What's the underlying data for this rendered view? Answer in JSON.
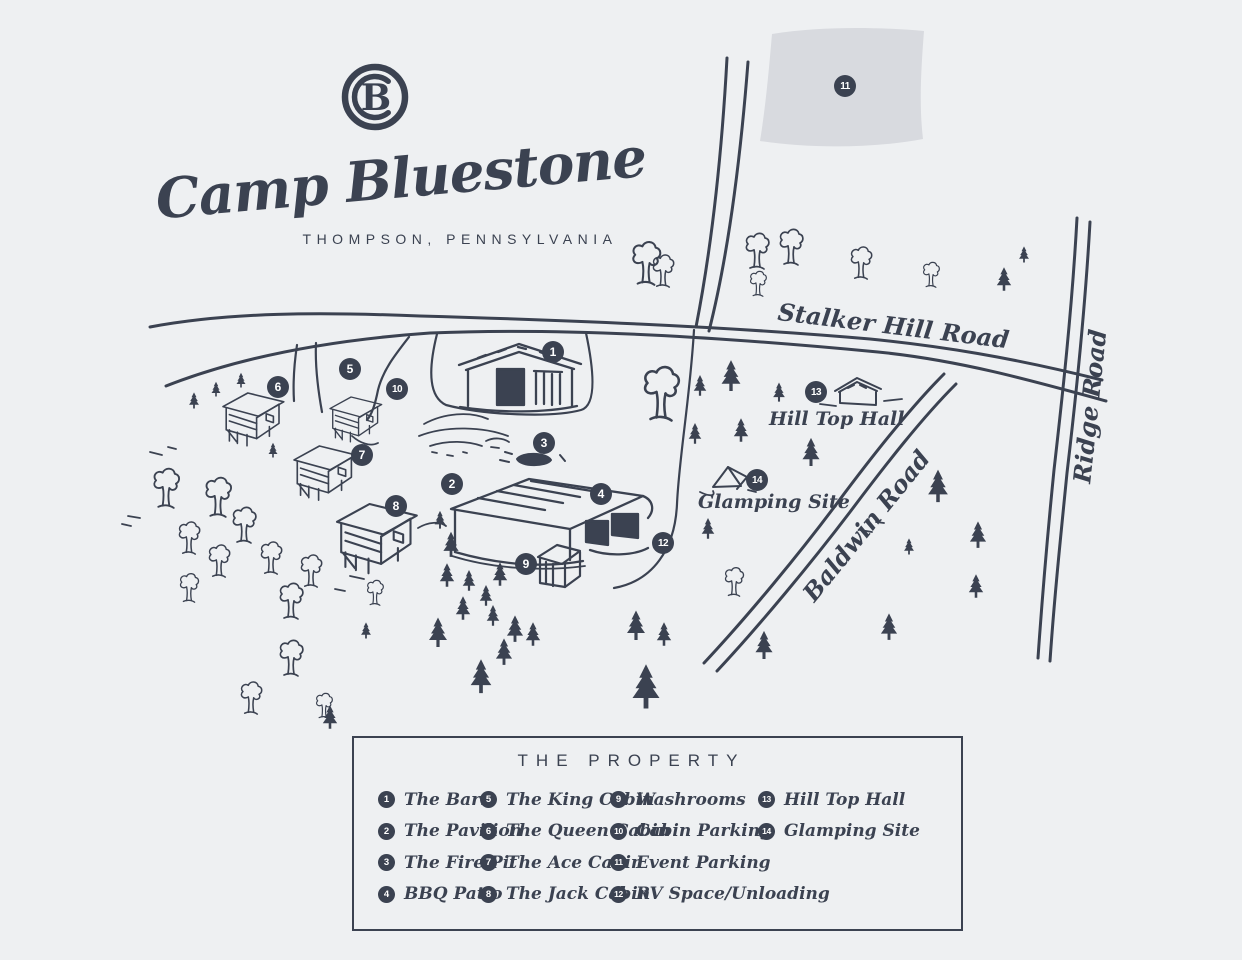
{
  "colors": {
    "ink": "#3b4251",
    "background": "#eef0f2",
    "parking_fill": "#d8dadf"
  },
  "logo": {
    "monogram": "B",
    "title": "Camp Bluestone",
    "subtitle": "THOMPSON, PENNSYLVANIA"
  },
  "map": {
    "road_labels": [
      {
        "id": "stalker",
        "text": "Stalker Hill Road"
      },
      {
        "id": "ridge",
        "text": "Ridge Road"
      },
      {
        "id": "baldwin",
        "text": "Baldwin Road"
      }
    ],
    "site_labels": [
      {
        "id": "hilltop",
        "text": "Hill Top Hall"
      },
      {
        "id": "glamping",
        "text": "Glamping Site"
      }
    ],
    "markers": [
      {
        "num": "1",
        "x": 553,
        "y": 352
      },
      {
        "num": "2",
        "x": 452,
        "y": 484
      },
      {
        "num": "3",
        "x": 544,
        "y": 443
      },
      {
        "num": "4",
        "x": 601,
        "y": 494
      },
      {
        "num": "5",
        "x": 350,
        "y": 369
      },
      {
        "num": "6",
        "x": 278,
        "y": 387
      },
      {
        "num": "7",
        "x": 362,
        "y": 455
      },
      {
        "num": "8",
        "x": 396,
        "y": 506
      },
      {
        "num": "9",
        "x": 526,
        "y": 564
      },
      {
        "num": "10",
        "x": 397,
        "y": 389
      },
      {
        "num": "11",
        "x": 845,
        "y": 86
      },
      {
        "num": "12",
        "x": 663,
        "y": 543
      },
      {
        "num": "13",
        "x": 816,
        "y": 392
      },
      {
        "num": "14",
        "x": 757,
        "y": 480
      }
    ]
  },
  "legend": {
    "title": "THE PROPERTY",
    "columns": [
      {
        "items": [
          {
            "num": "1",
            "label": "The Barn"
          },
          {
            "num": "2",
            "label": "The Pavilion"
          },
          {
            "num": "3",
            "label": "The Fire Pit"
          },
          {
            "num": "4",
            "label": "BBQ Patio"
          }
        ]
      },
      {
        "items": [
          {
            "num": "5",
            "label": "The King Cabin"
          },
          {
            "num": "6",
            "label": "The Queen Cabin"
          },
          {
            "num": "7",
            "label": "The Ace Cabin"
          },
          {
            "num": "8",
            "label": "The Jack Cabin"
          }
        ]
      },
      {
        "items": [
          {
            "num": "9",
            "label": "Washrooms"
          },
          {
            "num": "10",
            "label": "Cabin Parking"
          },
          {
            "num": "11",
            "label": "Event Parking"
          },
          {
            "num": "12",
            "label": "RV Space/Unloading"
          }
        ]
      },
      {
        "items": [
          {
            "num": "13",
            "label": "Hill Top Hall"
          },
          {
            "num": "14",
            "label": "Glamping Site"
          }
        ]
      }
    ]
  }
}
